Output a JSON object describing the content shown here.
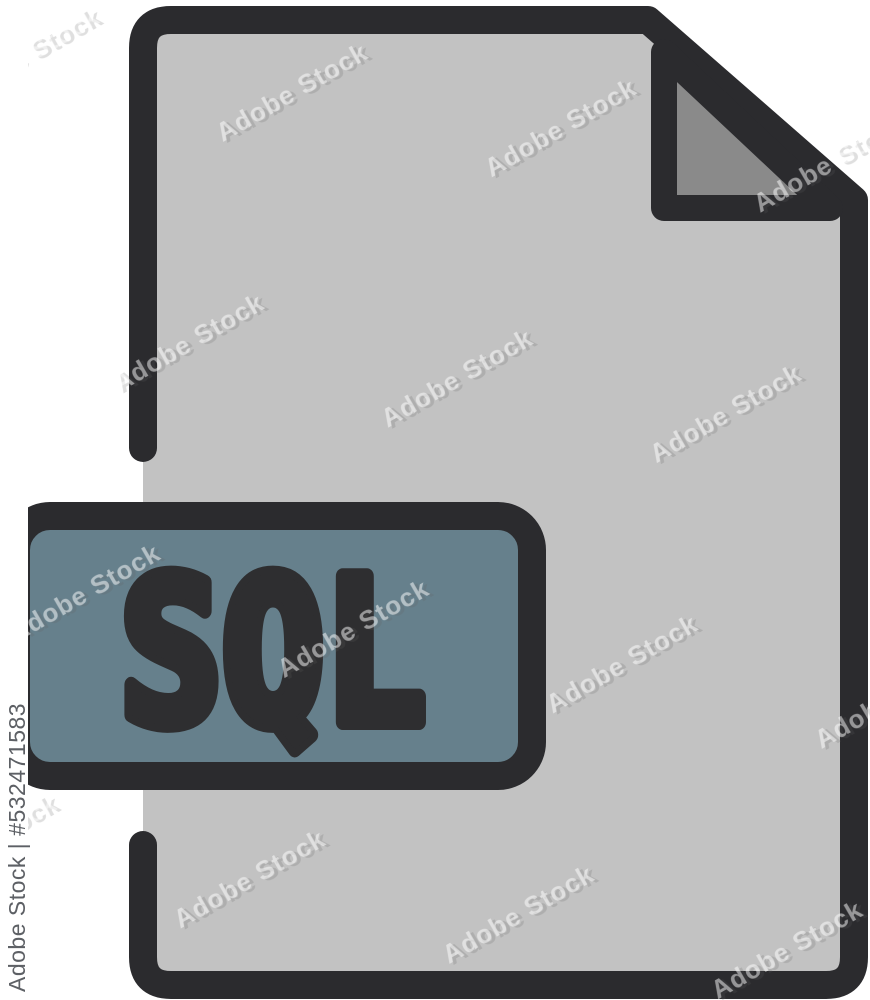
{
  "image": {
    "background_color": "#ffffff",
    "watermark": {
      "tile_text": "Adobe Stock",
      "credit_text": "Adobe Stock | #532471583"
    },
    "icon": {
      "label_text": "SQL",
      "colors": {
        "outline": "#2b2b2e",
        "document_fill": "#c2c2c2",
        "fold_fill": "#8a8a8a",
        "label_fill": "#66808c",
        "label_text_color": "#2e2e30",
        "credit_strip_fill": "#ffffff"
      }
    }
  }
}
